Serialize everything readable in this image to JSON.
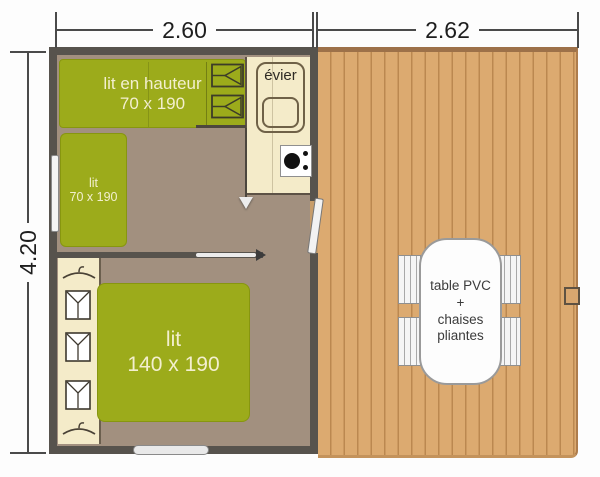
{
  "dimensions": {
    "width_cabin": "2.60",
    "width_terrace": "2.62",
    "height": "4.20"
  },
  "cabin": {
    "bunk_bed": {
      "line1": "lit en hauteur",
      "line2": "70 x 190"
    },
    "kitchen": {
      "sink_label": "évier"
    },
    "single_bed": {
      "line1": "lit",
      "line2": "70 x 190"
    },
    "double_bed": {
      "line1": "lit",
      "line2": "140 x 190"
    }
  },
  "terrace": {
    "table": {
      "line1": "table PVC",
      "line2": "+",
      "line3": "chaises",
      "line4": "pliantes"
    }
  },
  "icons": {
    "ladder": "bunk-ladder-steps",
    "hanger": "clothes-hanger",
    "shirt": "folded-shirt",
    "stove": "cooktop-burner",
    "sink": "double-sink",
    "slide_arrows": "sliding-door-direction-arrows"
  },
  "colors": {
    "wall": "#57534d",
    "floor": "#a2907f",
    "bed_green": "#9cab1b",
    "counter_cream": "#f4ebc9",
    "deck_wood": "#dcaa70",
    "deck_line": "#bb8850",
    "dimension_line": "#4a4a4a"
  }
}
